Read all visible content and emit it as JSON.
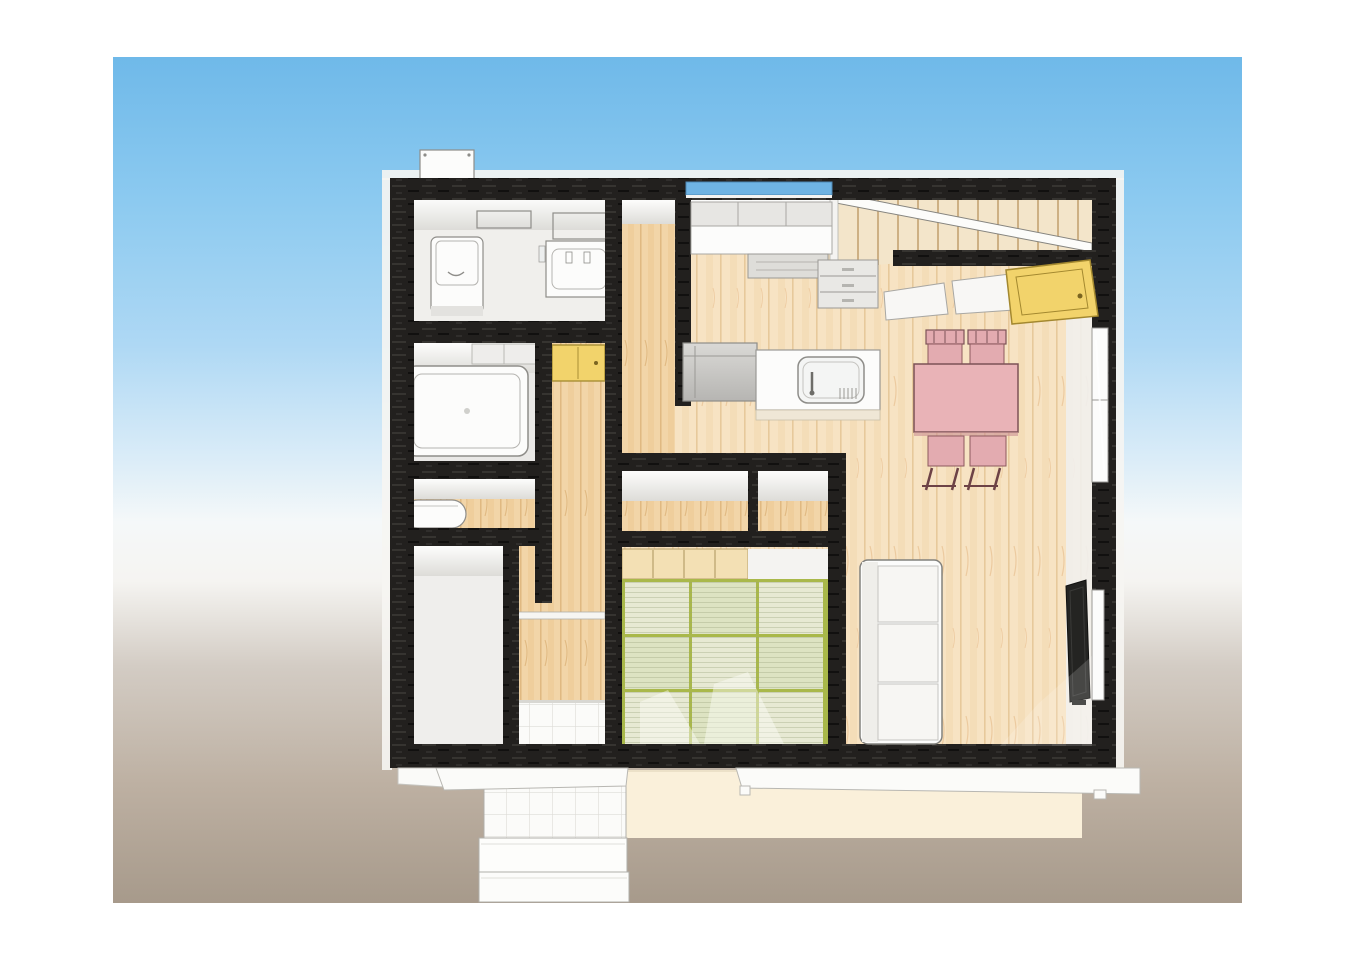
{
  "scene": {
    "type": "3d-floor-plan-rendering",
    "view": "birds-eye",
    "rooms": [
      "toilet-room",
      "bathroom",
      "washroom",
      "storage-room",
      "hallway",
      "corridor",
      "entrance-hall",
      "tatami-room",
      "living-dining-kitchen",
      "staircase"
    ],
    "furniture": [
      "toilet",
      "vanity-sink",
      "bathtub",
      "washbasin",
      "hall-cabinet",
      "kitchen-upper-cabinets",
      "kitchen-counter",
      "cooktop",
      "refrigerator",
      "island-sink-counter",
      "under-stair-drawer-cabinet",
      "under-stair-desk-boards",
      "yellow-storage-cabinet",
      "dining-table",
      "dining-chairs",
      "sofa",
      "wall-tv",
      "tatami-mats",
      "closet-sliding-doors"
    ],
    "exterior": [
      "vent-box",
      "kitchen-window",
      "tall-window",
      "tv-side-window",
      "porch-steps",
      "terrace",
      "eaves"
    ],
    "counts": {
      "tatami_mats": 9,
      "dining_chairs": 4,
      "porch_steps": 3
    }
  },
  "colors": {
    "sky-top": "#6fb9e9",
    "sky-mid": "#aed8f4",
    "horizon": "#f5f8f9",
    "ground-light": "#d3ccc4",
    "ground-dark": "#a79a8b",
    "wall-black": "#22201e",
    "wood-light": "#f7e3c3",
    "wood-line": "#e7c99b",
    "wood-warm": "#f2d5a8",
    "wood-warm-line": "#dfb67e",
    "tatami-a": "#e7e9d3",
    "tatami-b": "#dde3c2",
    "tatami-edge": "#a9b84a",
    "closet-tan": "#f3e0b4",
    "accent-yellow": "#f2d36b",
    "pink-table": "#e9b3b7",
    "pink-chair": "#e3abb0",
    "window-blue": "#6fb3e3",
    "terrace-cream": "#faf0da",
    "outline-gray": "#8e8d89"
  }
}
